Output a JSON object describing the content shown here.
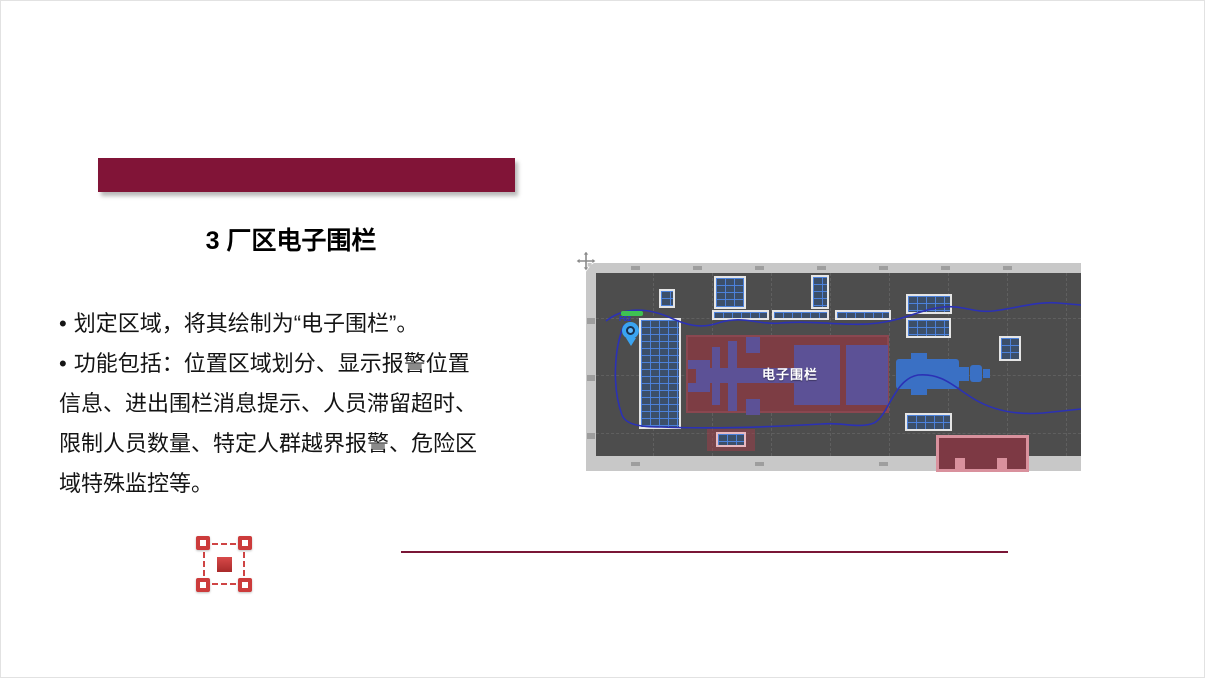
{
  "slide": {
    "accent_color": "#811437",
    "title": "3 厂区电子围栏",
    "bullet_char": "•",
    "bullets": [
      "划定区域，将其绘制为“电子围栏”。",
      "功能包括：位置区域划分、显示报警位置信息、进出围栏消息提示、人员滞留超时、限制人员数量、特定人群越界报警、危险区域特殊监控等。"
    ],
    "divider_color": "#7a1636"
  },
  "map": {
    "fence_label": "电子围栏",
    "pin_label": "F62",
    "colors": {
      "map_background": "#4d4d4d",
      "frame_band": "#c8c8c8",
      "building_grid_fill": "#3c4f69",
      "building_grid_line": "#4d84e0",
      "fence_zone_fill": "#7d3d44",
      "machinery_purple": "#5c5196",
      "machinery_blue": "#3a70c4",
      "route_line": "#2b31b5",
      "alert_zone_fill": "#7d3944",
      "alert_zone_border": "#d9919d",
      "pin_blue": "#3aa4f2",
      "status_green": "#3ec253"
    }
  },
  "fence_icon": {
    "fill_color": "#c0392b",
    "handle_color": "#cc3b3b"
  }
}
